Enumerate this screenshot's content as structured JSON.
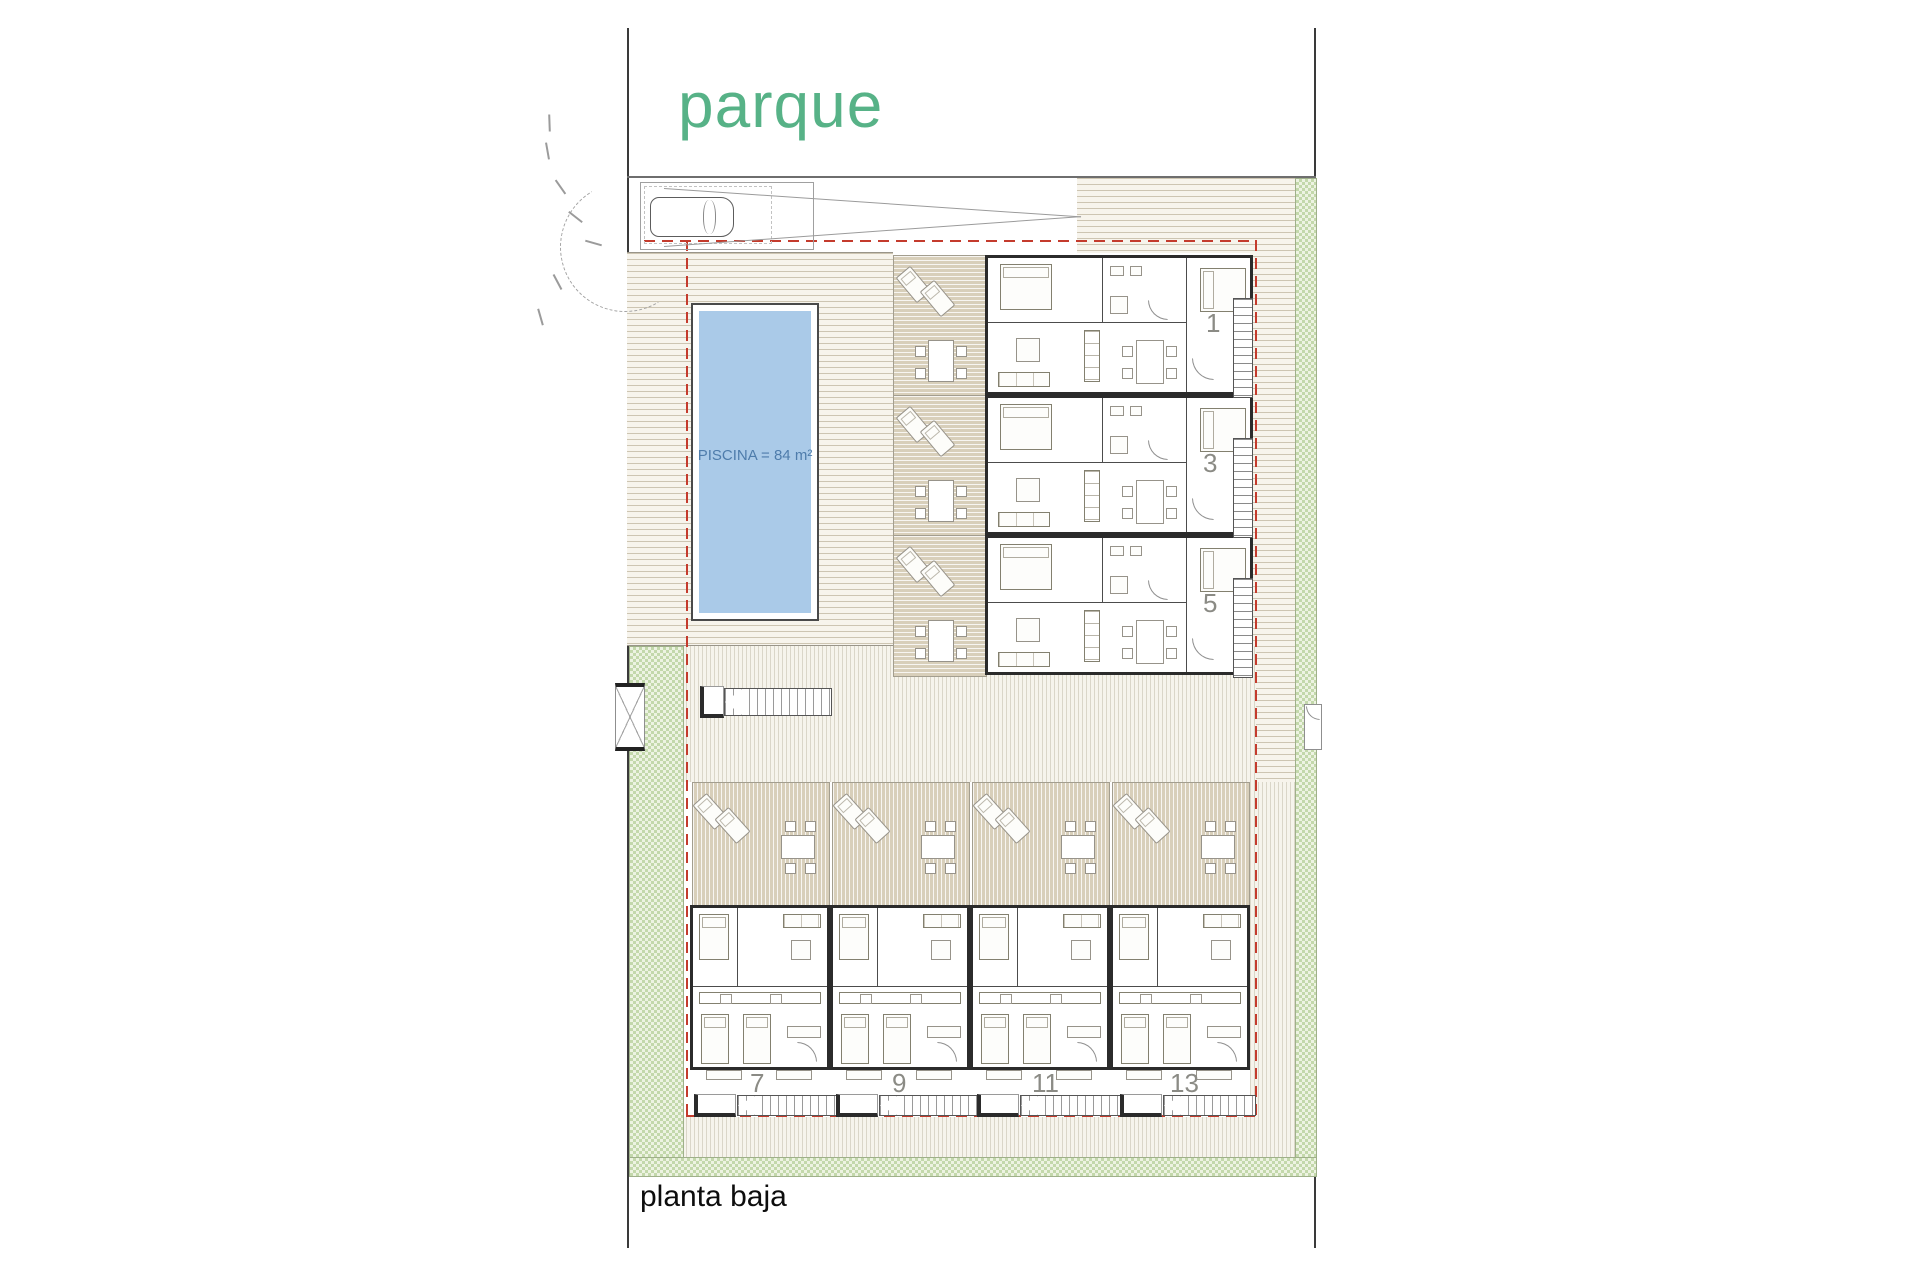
{
  "plan": {
    "park_label": "parque",
    "pool_label": "PISCINA = 84 m²",
    "floor_label": "planta baja",
    "upper_unit_numbers": [
      "1",
      "3",
      "5"
    ],
    "lower_unit_numbers": [
      "7",
      "9",
      "11",
      "13"
    ]
  },
  "colors": {
    "park_text": "#57b287",
    "pool_fill": "#aacae8",
    "pool_text": "#4e7cab",
    "boundary_dashed_red": "#c43b2d",
    "terrace_tan": "#d8cfba",
    "green_verge": "#c3d8ab",
    "wall": "#2b2b2b"
  }
}
